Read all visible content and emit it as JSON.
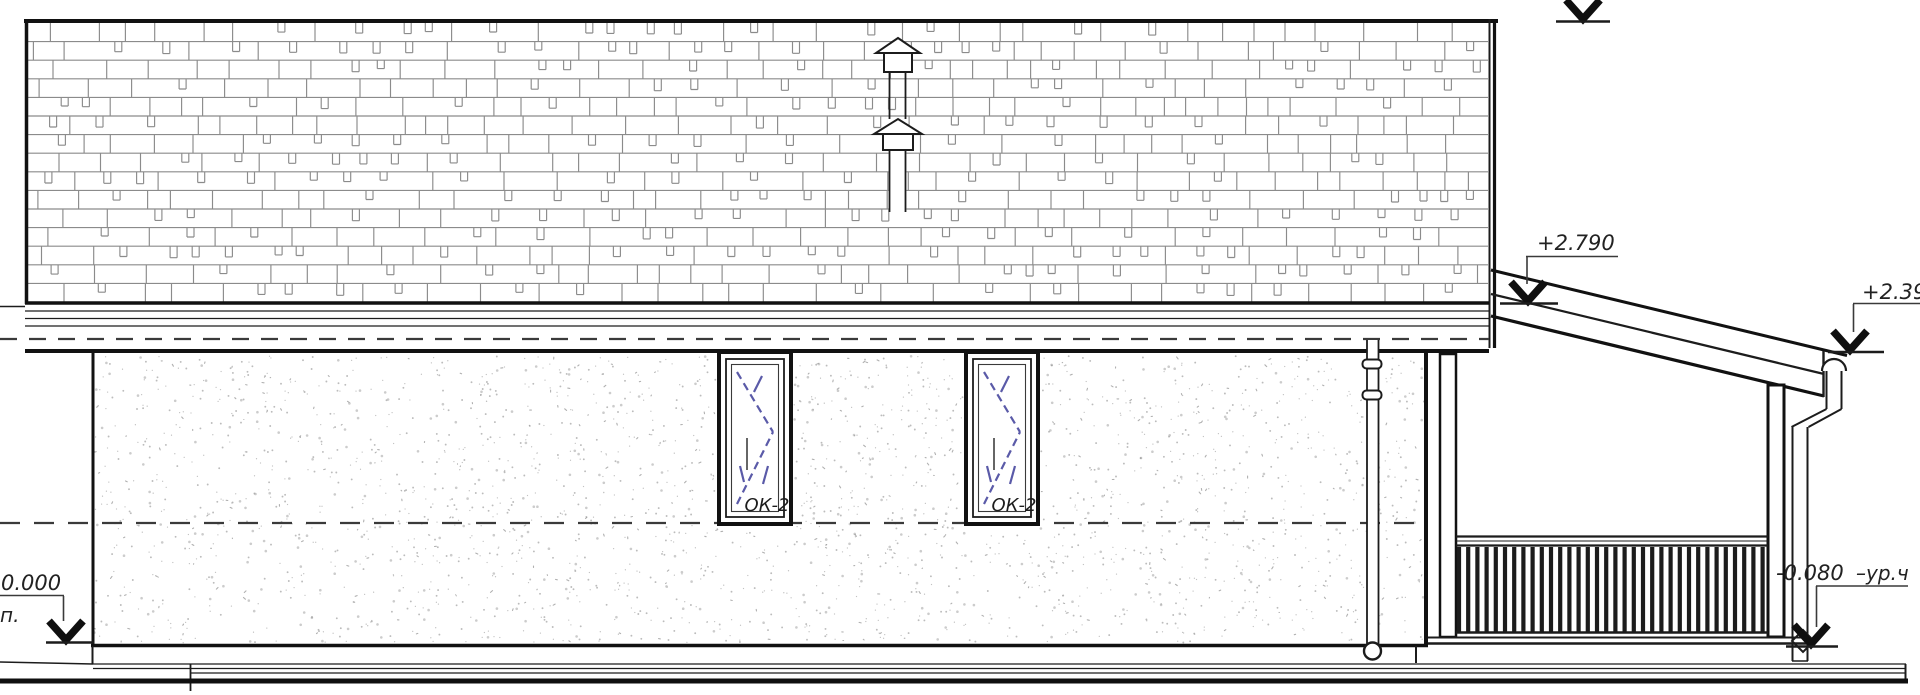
{
  "labels": {
    "window": "ОК-2",
    "elev_porch_high": "+2.790",
    "elev_porch_low": "+2.39",
    "elev_floor": "0.000",
    "elev_floor_sub": "п.",
    "elev_terrace": "-0.080",
    "elev_terrace_suffix": "–ур.ч"
  },
  "colors": {
    "line": "#1c1c1c",
    "hatch": "#8b8b8b",
    "stipple": "#8f8f8f",
    "glazing_mark": "#5a5aa8",
    "background": "#ffffff"
  }
}
